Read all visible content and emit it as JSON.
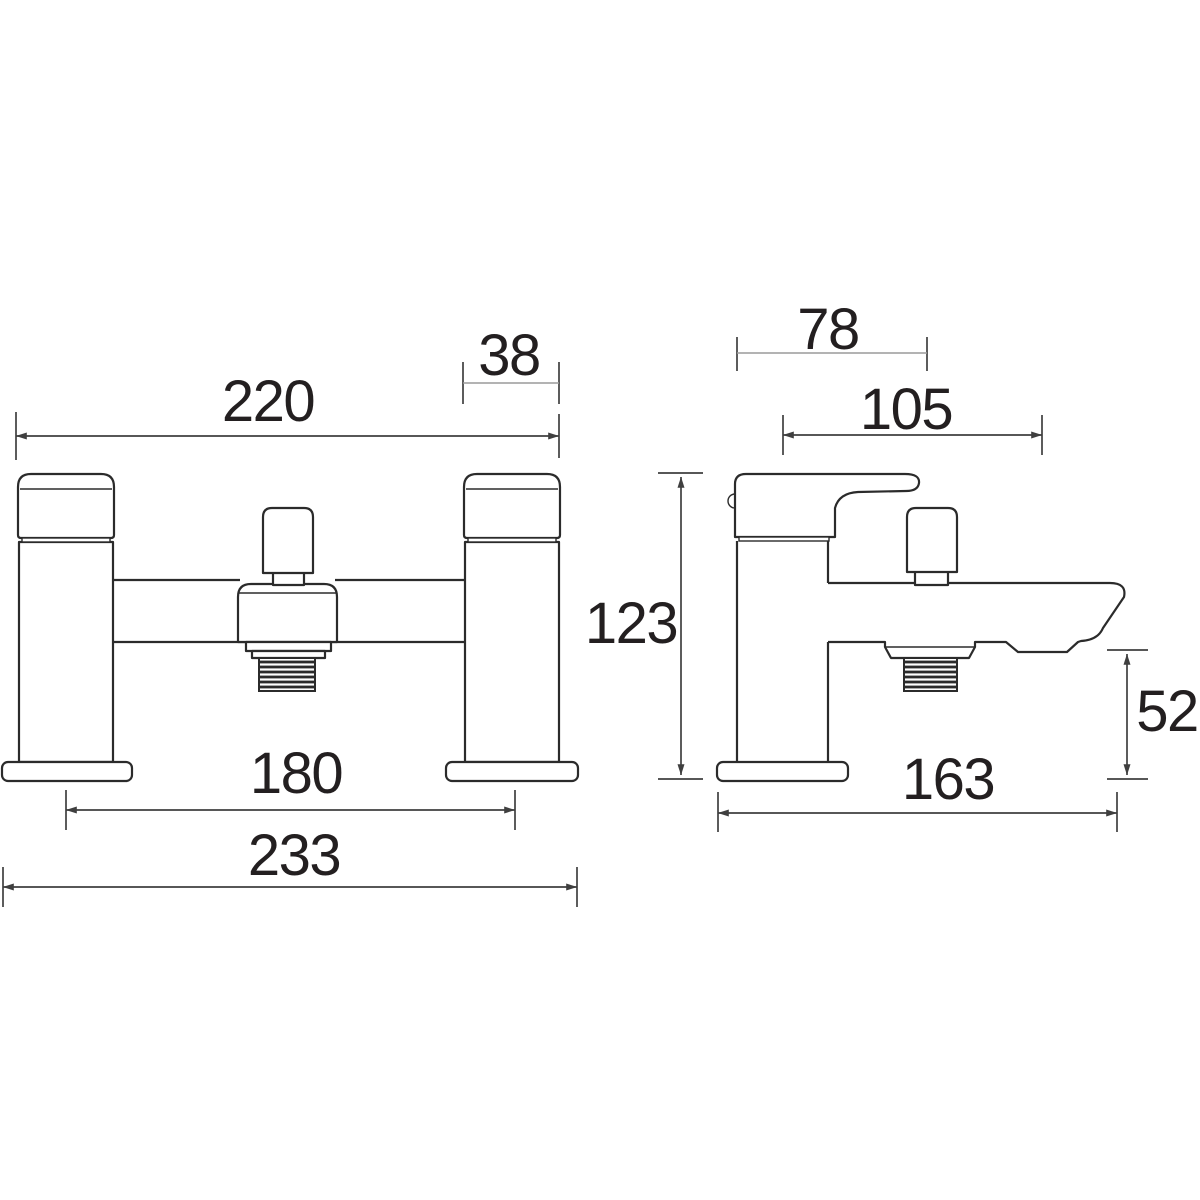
{
  "drawing": {
    "subject": "Bath shower mixer tap technical dimension drawing, front and side elevations",
    "views": {
      "front": {
        "name": "front-elevation",
        "dims": {
          "overall_width": "220",
          "handle_width": "38",
          "inlet_centres": "180",
          "base_overall_width": "233"
        }
      },
      "side": {
        "name": "side-elevation",
        "dims": {
          "handle_depth": "78",
          "spout_projection": "105",
          "overall_height": "123",
          "outlet_to_base": "52",
          "overall_depth": "163"
        }
      }
    },
    "style": {
      "object_line": "#2b2b2b",
      "dim_line": "#3f3f3f",
      "thin_dim_line": "#9a9a9a",
      "label_color": "#231f20",
      "background": "#ffffff"
    }
  }
}
